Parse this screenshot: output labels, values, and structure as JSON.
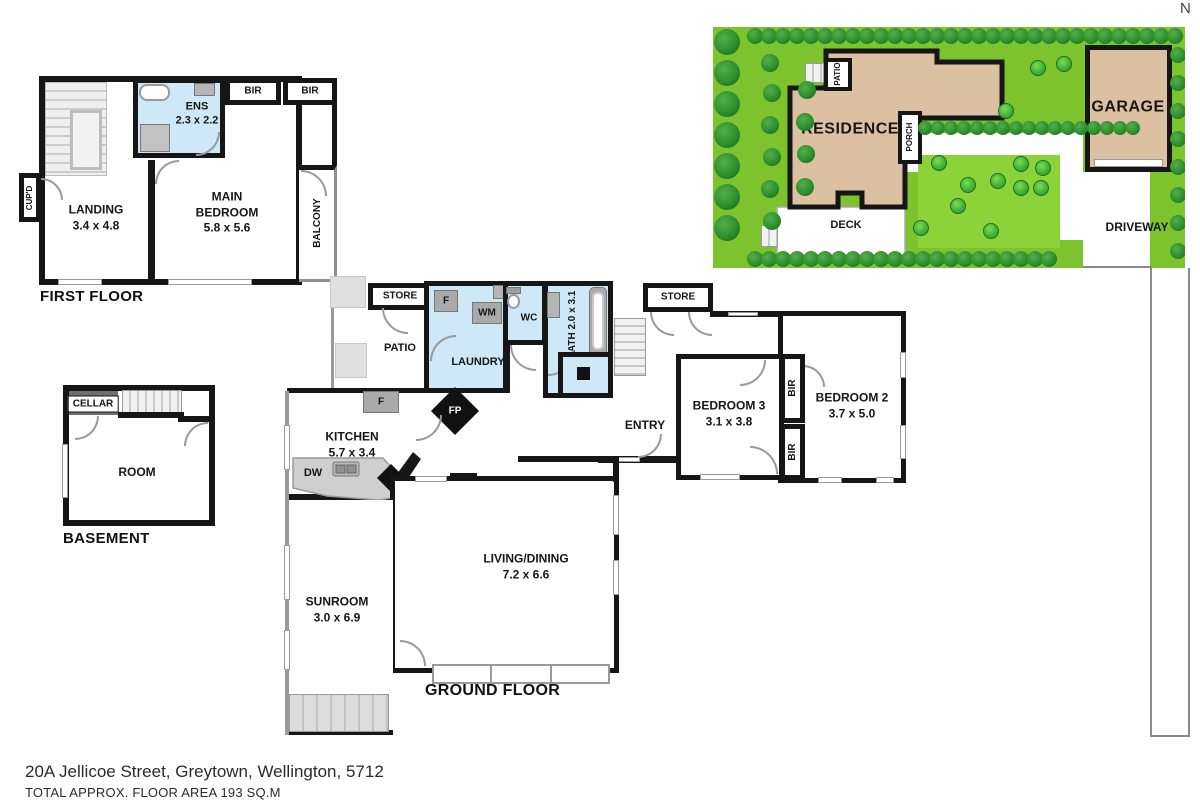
{
  "colors": {
    "wall": "#161616",
    "water_blue": "#cfe8f7",
    "lawn": "#7cc32d",
    "lawn_light": "#8bd338",
    "tree_dark": "#2e8f2e",
    "tree_light": "#3fae37",
    "building": "#dcc0a2",
    "fixture_gray": "#b5b5b5",
    "floor_gray": "#e3e3e3"
  },
  "compass": {
    "label": "N"
  },
  "first_floor": {
    "title": "FIRST FLOOR",
    "landing": {
      "name": "LANDING",
      "dims": "3.4 x 4.8"
    },
    "main_bedroom": {
      "name": "MAIN BEDROOM",
      "dims": "5.8 x 5.6"
    },
    "ens": {
      "name": "ENS",
      "dims": "2.3 x 2.2"
    },
    "bir": "BIR",
    "balcony": "BALCONY",
    "cupd": "CUP'D"
  },
  "site": {
    "residence": "RESIDENCE",
    "garage": "GARAGE",
    "deck": "DECK",
    "driveway": "DRIVEWAY",
    "patio": "PATIO",
    "porch": "PORCH"
  },
  "basement": {
    "title": "BASEMENT",
    "cellar": "CELLAR",
    "room": "ROOM"
  },
  "ground_floor": {
    "title": "GROUND FLOOR",
    "kitchen": {
      "name": "KITCHEN",
      "dims": "5.7 x 3.4"
    },
    "living": {
      "name": "LIVING/DINING",
      "dims": "7.2 x 6.6"
    },
    "sunroom": {
      "name": "SUNROOM",
      "dims": "3.0 x 6.9"
    },
    "bedroom2": {
      "name": "BEDROOM 2",
      "dims": "3.7 x 5.0"
    },
    "bedroom3": {
      "name": "BEDROOM 3",
      "dims": "3.1 x 3.8"
    },
    "bath": {
      "name": "BATH",
      "dims": "2.0 x 3.1"
    },
    "laundry": "LAUNDRY",
    "wc": "WC",
    "entry": "ENTRY",
    "patio": "PATIO",
    "store": "STORE",
    "pantry": "PNTRY",
    "fridge": "F",
    "wm": "WM",
    "dw": "DW",
    "fp": "FP",
    "bir": "BIR"
  },
  "address": {
    "line1": "20A Jellicoe Street, Greytown, Wellington, 5712",
    "line2": "TOTAL APPROX. FLOOR AREA 193 SQ.M"
  }
}
